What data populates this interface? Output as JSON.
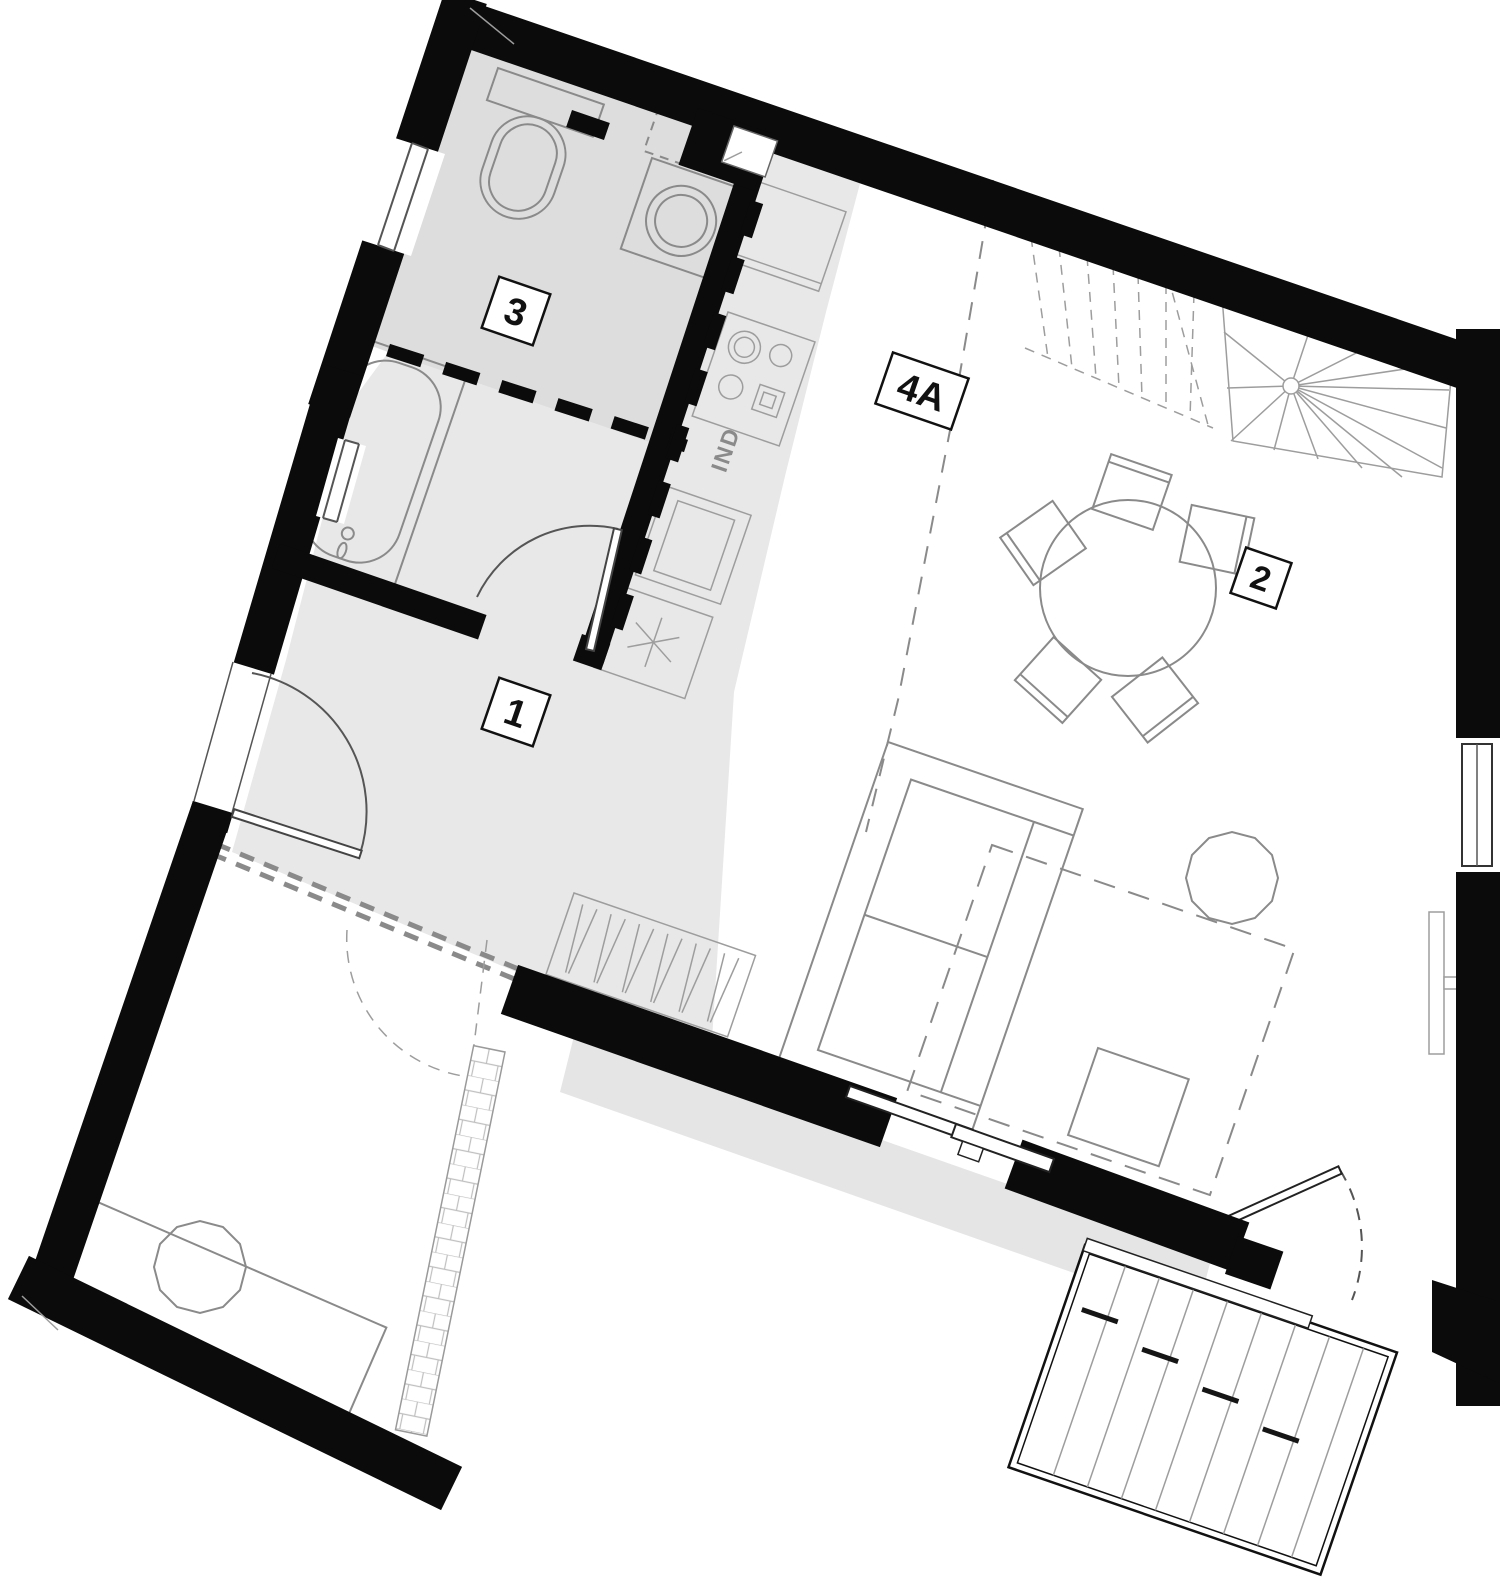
{
  "document": {
    "type": "architectural-floor-plan",
    "description": "Rotated apartment floor plan with bathroom, kitchen, living-dining room, winder stair, lower room and decked balcony"
  },
  "colors": {
    "wall": "#0b0b0b",
    "floorHall": "#e8e8e8",
    "floorBath": "#dddddd",
    "floorTerrace": "#e5e5e5",
    "line": "#8a8a8a",
    "lineLight": "#9d9d9d",
    "lineDark": "#555555",
    "labelBorder": "#111111",
    "labelText": "#111111"
  },
  "labels": {
    "room1": "1",
    "room2": "2",
    "room3": "3",
    "room4a": "4A",
    "hob": "IND"
  }
}
